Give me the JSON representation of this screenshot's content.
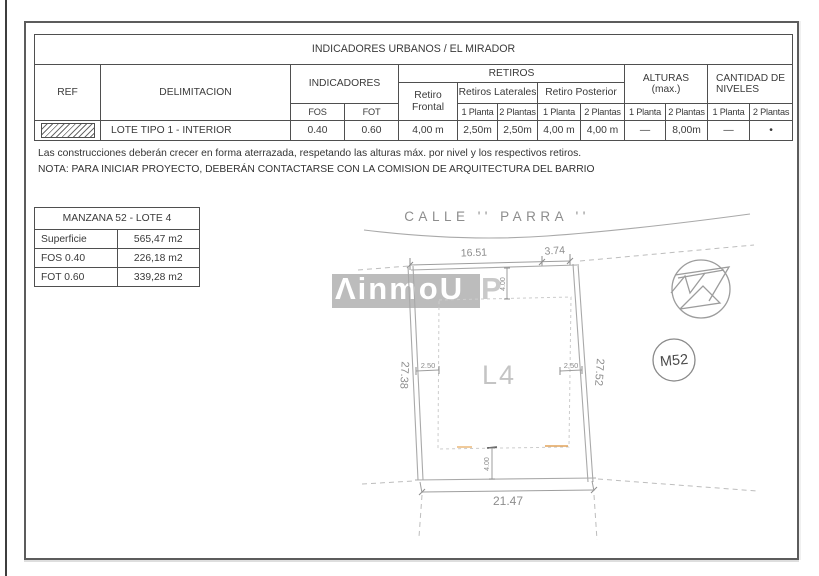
{
  "indicators_table": {
    "title": "INDICADORES URBANOS / EL MIRADOR",
    "headers": {
      "ref": "REF",
      "delimitacion": "DELIMITACION",
      "indicadores": "INDICADORES",
      "fos": "FOS",
      "fot": "FOT",
      "retiros": "RETIROS",
      "retiro_frontal": "Retiro Frontal",
      "retiros_laterales": "Retiros Laterales",
      "retiro_posterior": "Retiro Posterior",
      "alturas_line1": "ALTURAS",
      "alturas_line2": "(max.)",
      "cantidad_line1": "CANTIDAD DE",
      "cantidad_line2": "NIVELES",
      "p1": "1 Planta",
      "p2": "2 Plantas"
    },
    "row": {
      "delimitacion": "LOTE TIPO 1 - INTERIOR",
      "fos": "0.40",
      "fot": "0.60",
      "retiro_frontal": "4,00 m",
      "ret_lat_1p": "2,50m",
      "ret_lat_2p": "2,50m",
      "ret_post_1p": "4,00 m",
      "ret_post_2p": "4,00 m",
      "altura_1p": "—",
      "altura_2p": "8,00m",
      "niveles_1p": "—",
      "niveles_2p": "•"
    }
  },
  "notes": {
    "line1": "Las construcciones deberán crecer en forma aterrazada, respetando las alturas máx. por nivel y los respectivos retiros.",
    "line2": "NOTA: PARA INICIAR PROYECTO, DEBERÁN CONTACTARSE CON LA COMISION DE ARQUITECTURA DEL BARRIO"
  },
  "lot_table": {
    "title": "MANZANA 52 - LOTE 4",
    "rows": [
      {
        "label": "Superficie",
        "value": "565,47 m2"
      },
      {
        "label": "FOS  0.40",
        "value": "226,18 m2"
      },
      {
        "label": "FOT  0.60",
        "value": "339,28 m2"
      }
    ]
  },
  "plan": {
    "street_name": "CALLE  ''  PARRA  ''",
    "lot_label": "L4",
    "block_badge": "M52",
    "dims": {
      "front": "16.51",
      "chamfer": "3.74",
      "left_depth": "27.38",
      "right_depth": "27.52",
      "rear": "21.47",
      "setback_front": "4.00",
      "setback_rear": "4.00",
      "setback_left": "2.50",
      "setback_right": "2,50"
    }
  },
  "watermark": {
    "main": "ΛinmoU",
    "tail": "P"
  },
  "colors": {
    "accent_orange": "#e2a35a",
    "plan_line_gray": "#9e9e9e",
    "watermark_gray": "#bcbcbc",
    "border_dark": "#4f4f4f"
  }
}
